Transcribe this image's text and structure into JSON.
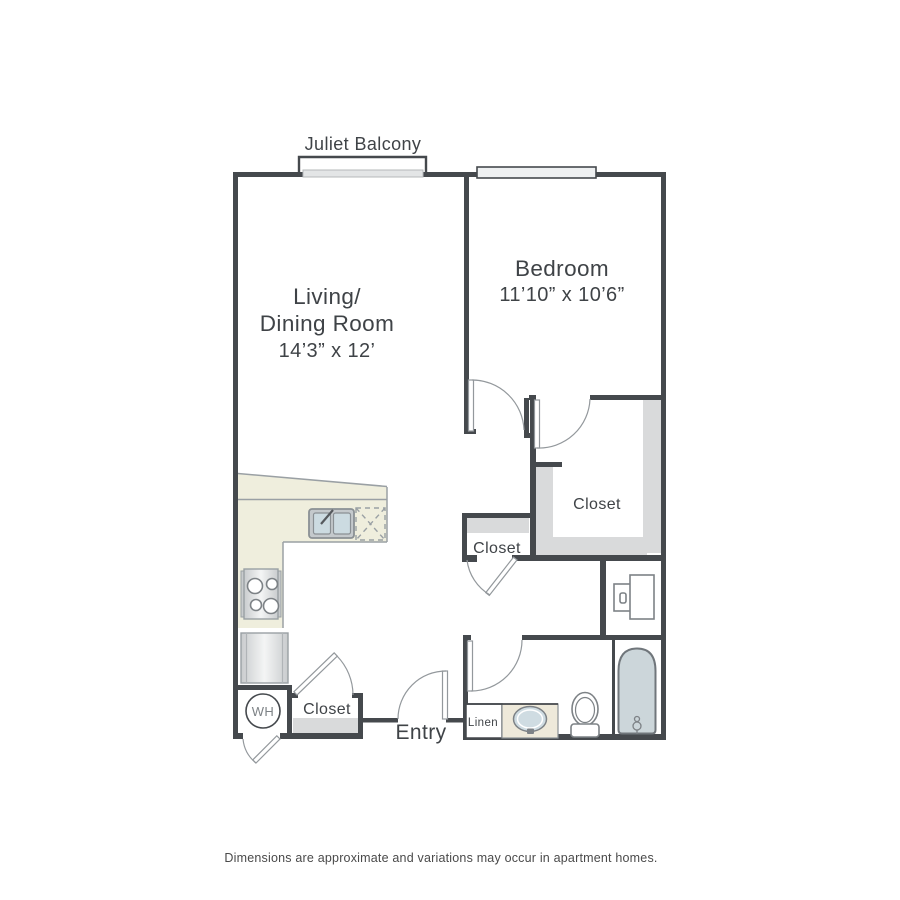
{
  "floorplan": {
    "balcony_label": "Juliet Balcony",
    "living_room": {
      "line1": "Living/",
      "line2": "Dining Room",
      "dims": "14’3” x 12’"
    },
    "bedroom": {
      "name": "Bedroom",
      "dims": "11’10” x 10’6”"
    },
    "walk_in_closet_label": "Closet",
    "hall_closet_label": "Closet",
    "entry_closet_label": "Closet",
    "entry_label": "Entry",
    "linen_label": "Linen",
    "water_heater_label": "WH",
    "disclaimer": "Dimensions are approximate and variations may occur in apartment homes.",
    "colors": {
      "wall": "#45494d",
      "fixture_stroke": "#7d8286",
      "shelf_gray": "#d9dadb",
      "counter_beige": "#efeedd",
      "vanity_beige": "#eee9da",
      "sink_blue": "#cfdce2",
      "tub_blue": "#ccd6da",
      "text": "#3f4347"
    }
  }
}
